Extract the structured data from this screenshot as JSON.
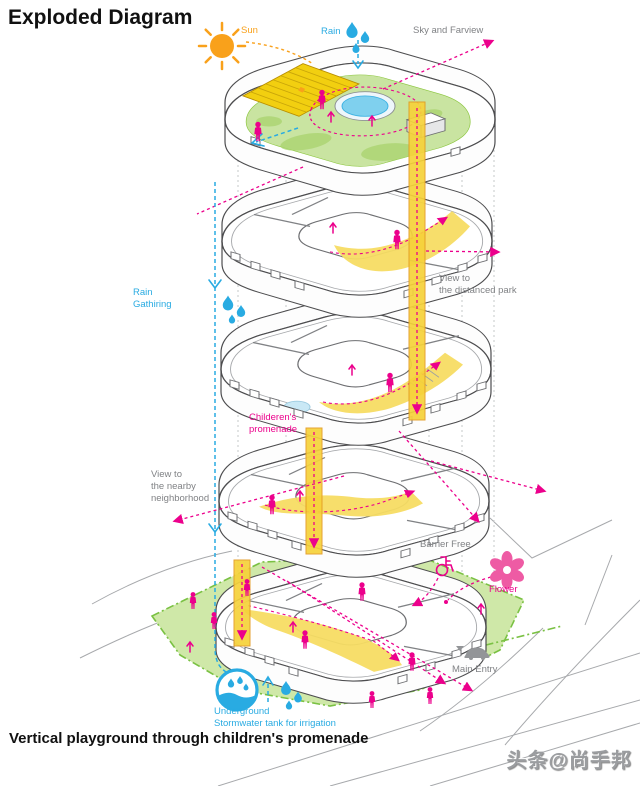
{
  "title": "Exploded Diagram",
  "footer": "Vertical playground through children's promenade",
  "watermark": "头条@尚手邦",
  "labels": {
    "sun": "Sun",
    "rain": "Rain",
    "sky_farview": "Sky and Farview",
    "rain_gathering": "Rain\nGathiring",
    "view_distanced_park": "View to\nthe distanced park",
    "childrens_promenade": "Childeren's\npromenade",
    "view_nearby": "View to\nthe nearby\nneighborhood",
    "barrier_free": "Barrier Free",
    "flower": "Flower",
    "main_entry": "Main Entry",
    "underground_tank": "Underground\nStormwater tank for irrigation"
  },
  "colors": {
    "pink": "#ec008c",
    "blue": "#29abe2",
    "orange": "#f9a11b",
    "gray-text": "#808285",
    "green-border": "#7ac143",
    "site-green": "#cfe8a8",
    "roof-green": "#c9e4a1",
    "blob-green": "#a8d36e",
    "promenade-yellow": "#f7dc63",
    "shaft-yellow": "#f6d23a",
    "solar-yellow": "#f2cf10",
    "pool-blue": "#7fd0ee",
    "road-gray": "#a7a9ac",
    "watermark-gray": "#9b9da0"
  }
}
